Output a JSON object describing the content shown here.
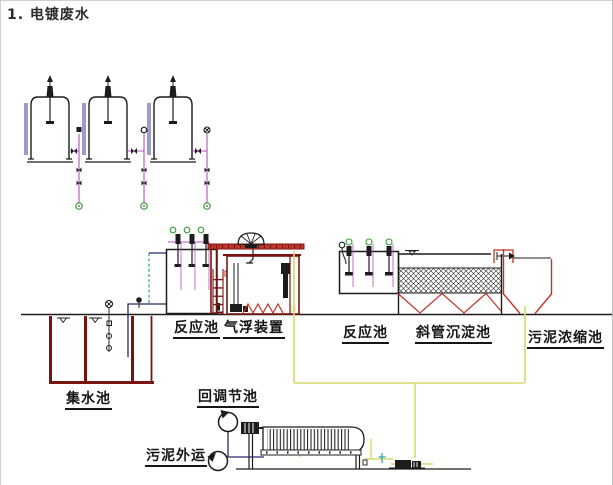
{
  "title": "1. 电镀废水",
  "diagram": {
    "labels": {
      "reaction_tank_1": "反应池",
      "air_flotation": "气浮装置",
      "reaction_tank_2": "反应池",
      "inclined_tube_settling": "斜管沉淀池",
      "sludge_thickening": "污泥浓缩池",
      "collection_tank": "集水池",
      "return_adjustment_tank": "回调节池",
      "sludge_hauling": "污泥外运"
    }
  },
  "colors": {
    "ink": "#1c1c1c",
    "maroon": "#7a1410",
    "accent_red": "#c13327",
    "dosing_pipe": "#b050c0",
    "sludge_pipe": "#d9d96a",
    "water_pipe": "#28286e",
    "air_pipe": "#2aa0a8",
    "terminal_green": "#2f9e2f",
    "gauge_blue": "#3a3a9a"
  }
}
